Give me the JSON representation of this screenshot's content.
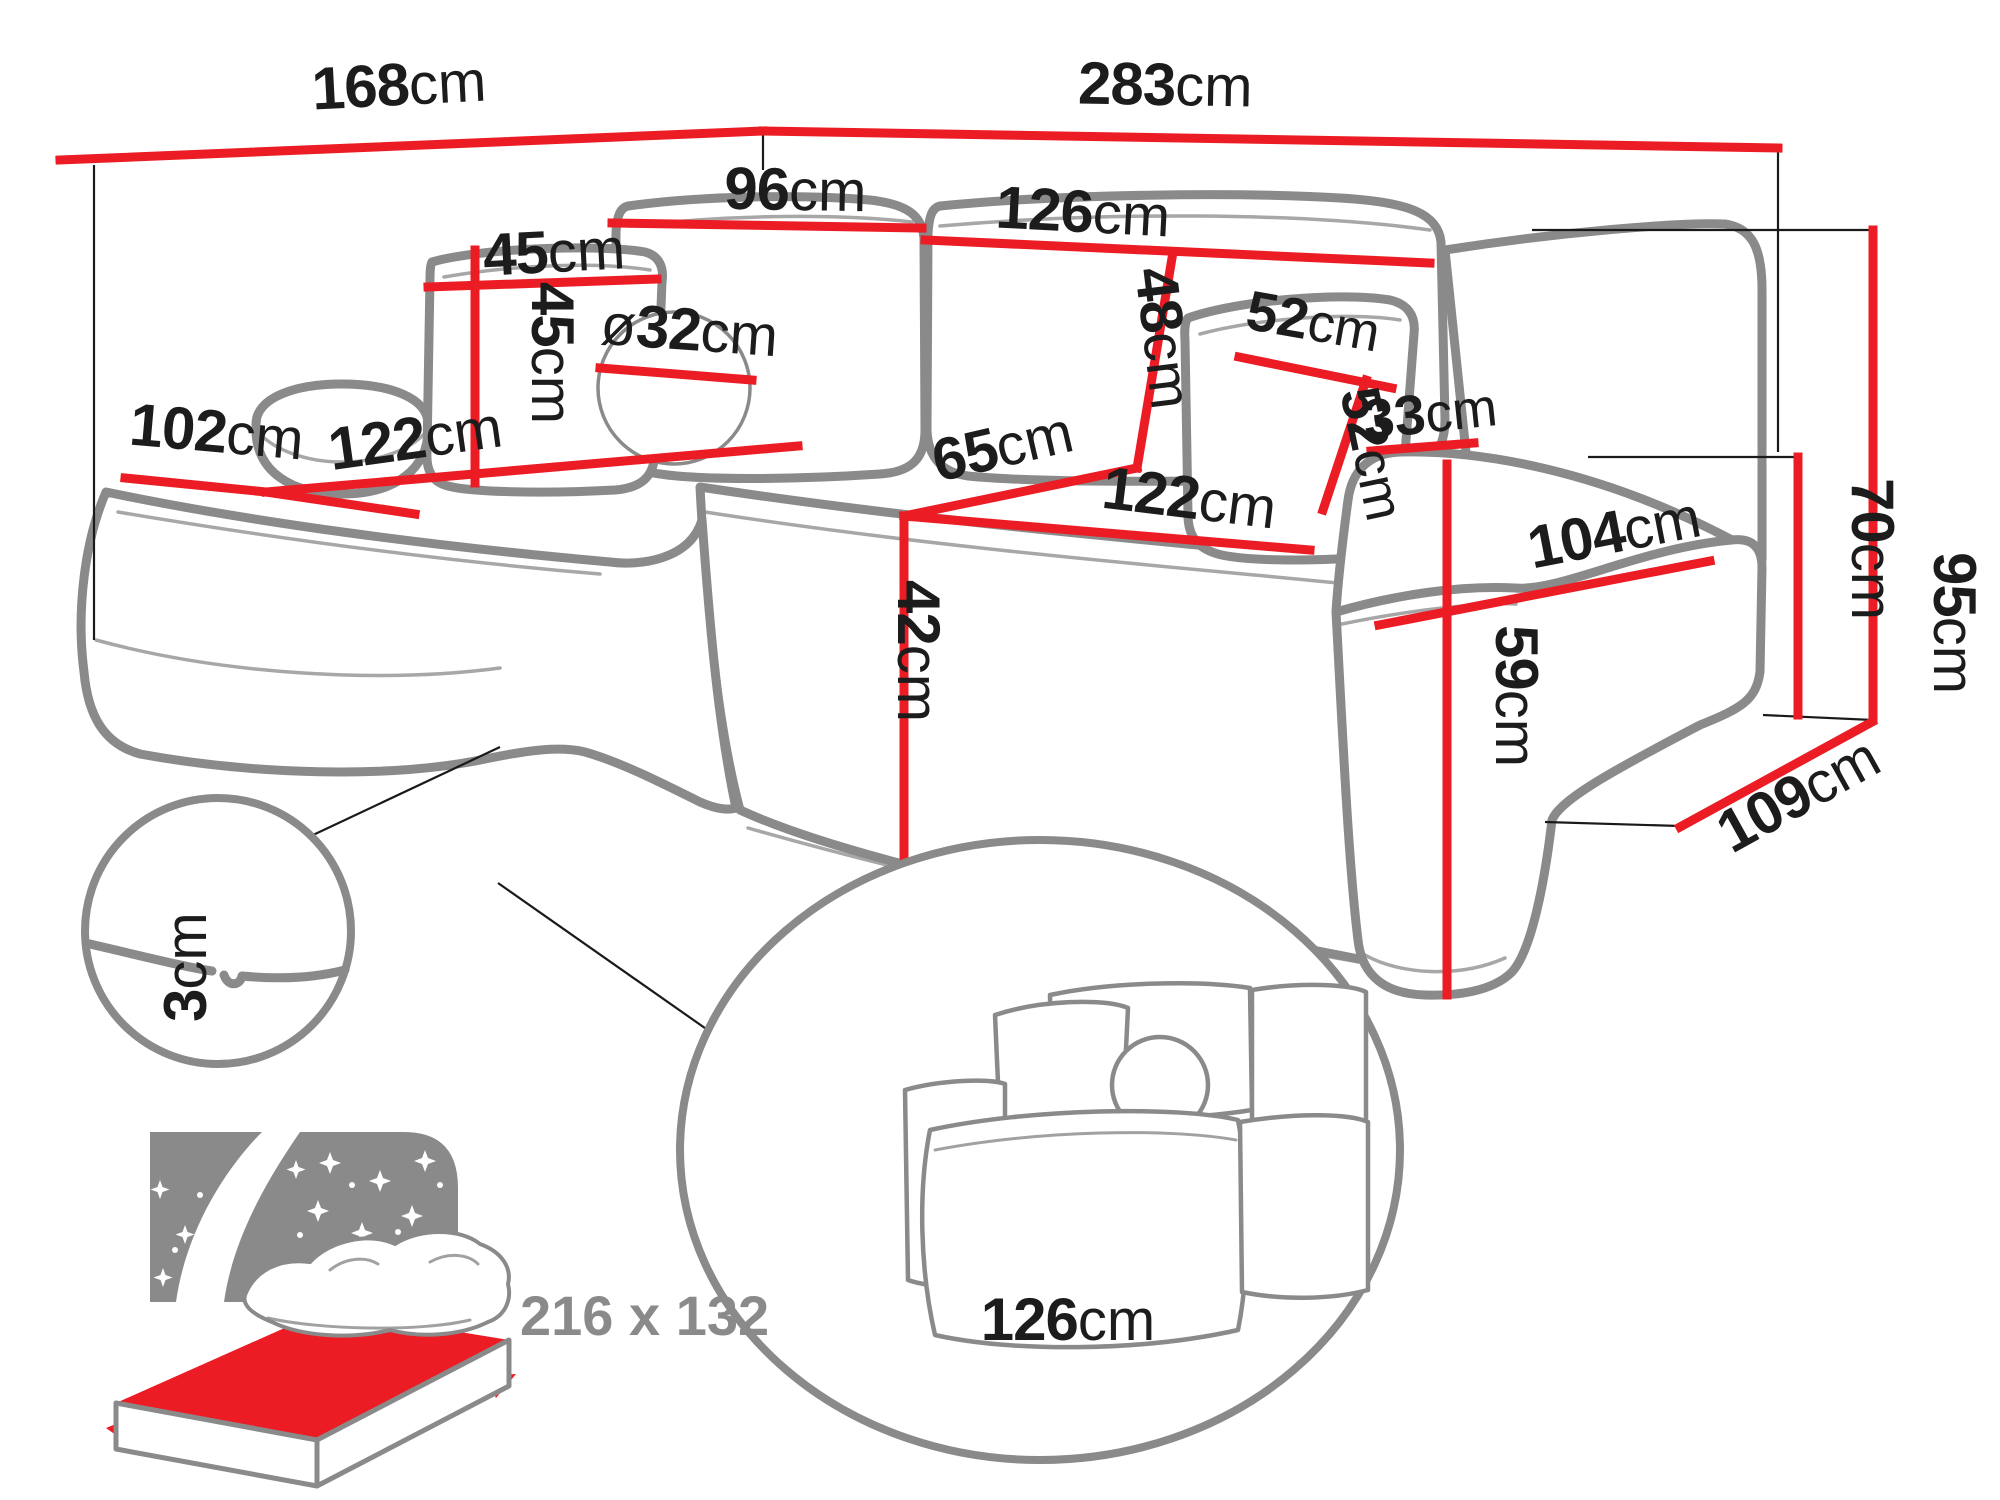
{
  "diagram": {
    "sofa_dimensions": {
      "width_left": {
        "value": "168",
        "unit": "cm"
      },
      "width_right": {
        "value": "283",
        "unit": "cm"
      },
      "back_cushion_left_width": {
        "value": "96",
        "unit": "cm"
      },
      "back_cushion_right_width": {
        "value": "126",
        "unit": "cm"
      },
      "small_pillow_width": {
        "value": "45",
        "unit": "cm"
      },
      "small_pillow_height": {
        "value": "45",
        "unit": "cm"
      },
      "round_cushion_diameter": {
        "prefix": "ø",
        "value": "32",
        "unit": "cm"
      },
      "side_pillow_width": {
        "value": "52",
        "unit": "cm"
      },
      "side_pillow_height": {
        "value": "52",
        "unit": "cm"
      },
      "chaise_width": {
        "value": "102",
        "unit": "cm"
      },
      "chaise_length": {
        "value": "122",
        "unit": "cm"
      },
      "seat_depth": {
        "value": "65",
        "unit": "cm"
      },
      "seat_length": {
        "value": "122",
        "unit": "cm"
      },
      "back_cushion_height": {
        "value": "48",
        "unit": "cm"
      },
      "seat_height": {
        "value": "42",
        "unit": "cm"
      },
      "armrest_width": {
        "value": "33",
        "unit": "cm"
      },
      "armrest_length": {
        "value": "104",
        "unit": "cm"
      },
      "armrest_height": {
        "value": "59",
        "unit": "cm"
      },
      "backrest_height": {
        "value": "70",
        "unit": "cm"
      },
      "total_height": {
        "value": "95",
        "unit": "cm"
      },
      "total_depth": {
        "value": "109",
        "unit": "cm"
      }
    },
    "details": {
      "floor_clearance": {
        "value": "3",
        "unit": "cm"
      },
      "sleeping_section_width": {
        "value": "126",
        "unit": "cm"
      },
      "sleeping_area_label": "216 x 132"
    },
    "colors": {
      "dimension_line": "#ec1c24",
      "outline": "#8a8a8a",
      "label": "#1c1c1c",
      "muted_label": "#8a8a8a"
    }
  }
}
